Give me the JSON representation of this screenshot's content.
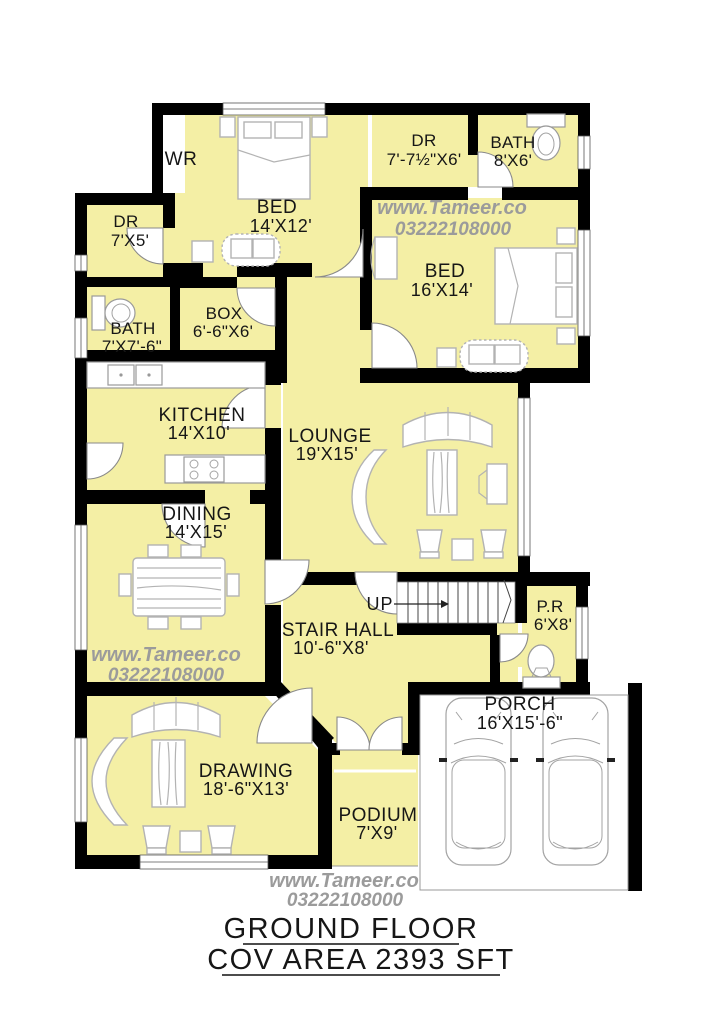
{
  "plan": {
    "rooms": [
      {
        "id": "wr",
        "name": "WR",
        "dims": ""
      },
      {
        "id": "bed1",
        "name": "BED",
        "dims": "14'X12'"
      },
      {
        "id": "dr1",
        "name": "DR",
        "dims": "7'-7½\"X6'"
      },
      {
        "id": "bath1",
        "name": "BATH",
        "dims": "8'X6'"
      },
      {
        "id": "dr2",
        "name": "DR",
        "dims": "7'X5'"
      },
      {
        "id": "bed2",
        "name": "BED",
        "dims": "16'X14'"
      },
      {
        "id": "bath2",
        "name": "BATH",
        "dims": "7'X7'-6\""
      },
      {
        "id": "box",
        "name": "BOX",
        "dims": "6'-6\"X6'"
      },
      {
        "id": "kitchen",
        "name": "KITCHEN",
        "dims": "14'X10'"
      },
      {
        "id": "lounge",
        "name": "LOUNGE",
        "dims": "19'X15'"
      },
      {
        "id": "dining",
        "name": "DINING",
        "dims": "14'X15'"
      },
      {
        "id": "stair",
        "name": "STAIR HALL",
        "dims": "10'-6\"X8'"
      },
      {
        "id": "pr",
        "name": "P.R",
        "dims": "6'X8'"
      },
      {
        "id": "drawing",
        "name": "DRAWING",
        "dims": "18'-6\"X13'"
      },
      {
        "id": "podium",
        "name": "PODIUM",
        "dims": "7'X9'"
      },
      {
        "id": "porch",
        "name": "PORCH",
        "dims": "16'X15'-6\""
      }
    ],
    "stair_label": "UP",
    "watermark": {
      "line1": "www.Tameer.co",
      "line2": "03222108000"
    },
    "footer": {
      "title": "GROUND FLOOR",
      "area": "COV AREA 2393 SFT"
    },
    "colors": {
      "room_fill": "#f4efa5",
      "wall": "#000000",
      "watermark": "#9b9b9b"
    }
  }
}
